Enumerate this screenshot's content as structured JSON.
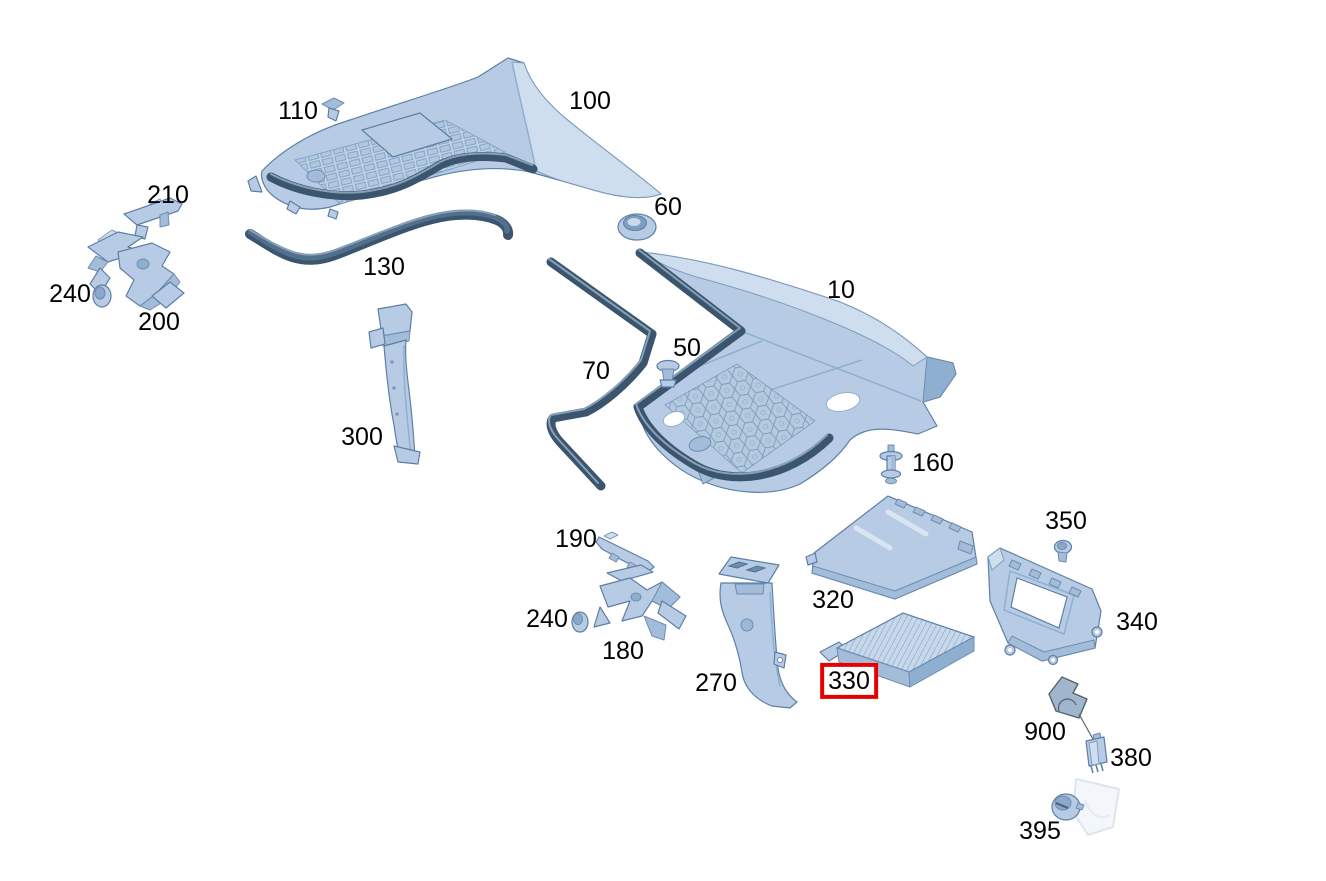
{
  "diagram": {
    "type": "exploded-parts-diagram",
    "subject": "cowl panel and air intake housing parts",
    "background": "#ffffff",
    "label_color": "#000000",
    "selected_part": "330",
    "highlight_box_color": "#e60000",
    "part_colors": {
      "body": "#b7cce4",
      "light": "#cfdeee",
      "shade": "#a3bcd9",
      "edge": "#5d7fa6",
      "seal": "#3b556e"
    },
    "labels": [
      {
        "text": "110",
        "x": 298,
        "y": 111
      },
      {
        "text": "100",
        "x": 590,
        "y": 101
      },
      {
        "text": "210",
        "x": 168,
        "y": 195
      },
      {
        "text": "240",
        "x": 70,
        "y": 294
      },
      {
        "text": "200",
        "x": 159,
        "y": 322
      },
      {
        "text": "130",
        "x": 384,
        "y": 267
      },
      {
        "text": "60",
        "x": 668,
        "y": 207
      },
      {
        "text": "10",
        "x": 841,
        "y": 290
      },
      {
        "text": "50",
        "x": 687,
        "y": 348
      },
      {
        "text": "70",
        "x": 596,
        "y": 371
      },
      {
        "text": "300",
        "x": 362,
        "y": 437
      },
      {
        "text": "160",
        "x": 933,
        "y": 463
      },
      {
        "text": "190",
        "x": 576,
        "y": 539
      },
      {
        "text": "350",
        "x": 1066,
        "y": 521
      },
      {
        "text": "240",
        "x": 547,
        "y": 619
      },
      {
        "text": "320",
        "x": 833,
        "y": 600
      },
      {
        "text": "180",
        "x": 623,
        "y": 651
      },
      {
        "text": "340",
        "x": 1137,
        "y": 622
      },
      {
        "text": "270",
        "x": 716,
        "y": 683
      },
      {
        "text": "330",
        "x": 849,
        "y": 681,
        "selected": true
      },
      {
        "text": "900",
        "x": 1045,
        "y": 732
      },
      {
        "text": "380",
        "x": 1131,
        "y": 758
      },
      {
        "text": "395",
        "x": 1040,
        "y": 831
      }
    ]
  }
}
